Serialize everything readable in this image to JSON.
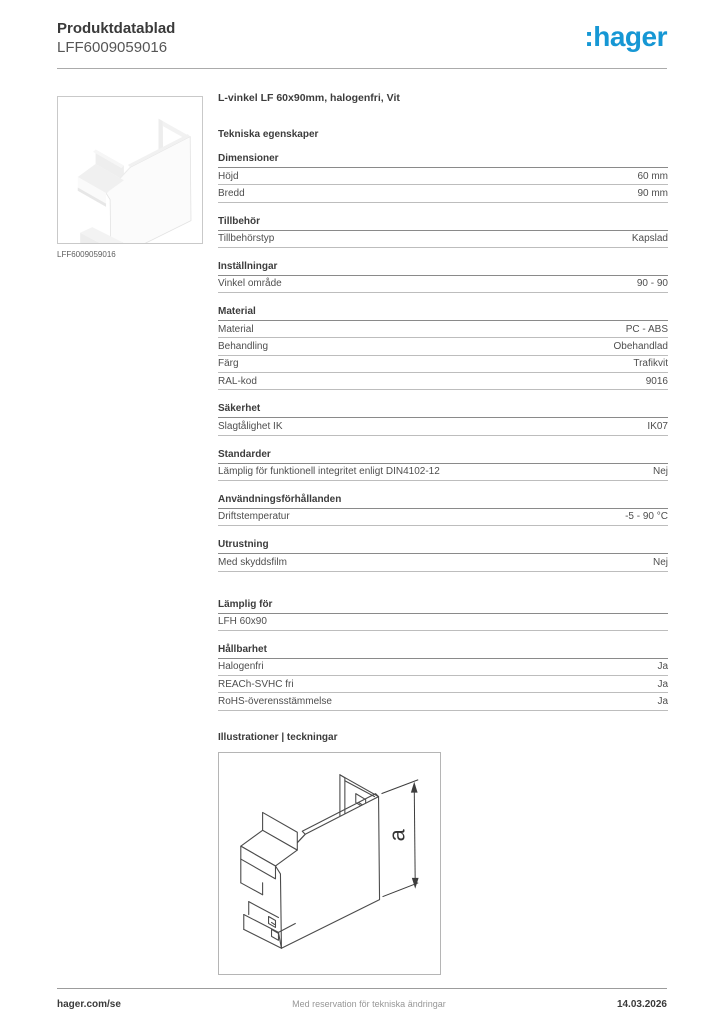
{
  "header": {
    "doc_type": "Produktdatablad",
    "reference": "LFF6009059016",
    "logo_text": ":hager",
    "brand_color": "#1697d4"
  },
  "product_image": {
    "caption": "LFF6009059016",
    "description": "white L-shaped flat-angle cover piece"
  },
  "product": {
    "title": "L-vinkel LF 60x90mm, halogenfri, Vit"
  },
  "specs": {
    "title": "Tekniska egenskaper",
    "sections": [
      {
        "title": "Dimensioner",
        "rows": [
          {
            "label": "Höjd",
            "value": "60 mm"
          },
          {
            "label": "Bredd",
            "value": "90 mm"
          }
        ]
      },
      {
        "title": "Tillbehör",
        "rows": [
          {
            "label": "Tillbehörstyp",
            "value": "Kapslad"
          }
        ]
      },
      {
        "title": "Inställningar",
        "rows": [
          {
            "label": "Vinkel område",
            "value": "90 - 90"
          }
        ]
      },
      {
        "title": "Material",
        "rows": [
          {
            "label": "Material",
            "value": "PC - ABS"
          },
          {
            "label": "Behandling",
            "value": "Obehandlad"
          },
          {
            "label": "Färg",
            "value": "Trafikvit"
          },
          {
            "label": "RAL-kod",
            "value": "9016"
          }
        ]
      },
      {
        "title": "Säkerhet",
        "rows": [
          {
            "label": "Slagtålighet IK",
            "value": "IK07"
          }
        ]
      },
      {
        "title": "Standarder",
        "rows": [
          {
            "label": "Lämplig för funktionell integritet enligt DIN4102-12",
            "value": "Nej"
          }
        ]
      },
      {
        "title": "Användningsförhållanden",
        "rows": [
          {
            "label": "Driftstemperatur",
            "value": "-5 - 90 °C"
          }
        ]
      },
      {
        "title": "Utrustning",
        "rows": [
          {
            "label": "Med skyddsfilm",
            "value": "Nej"
          }
        ]
      },
      {
        "title": "Lämplig för",
        "gap_before": true,
        "rows": [
          {
            "label": "LFH 60x90",
            "value": ""
          }
        ]
      },
      {
        "title": "Hållbarhet",
        "rows": [
          {
            "label": "Halogenfri",
            "value": "Ja"
          },
          {
            "label": "REACh-SVHC fri",
            "value": "Ja"
          },
          {
            "label": "RoHS-överensstämmelse",
            "value": "Ja"
          }
        ]
      }
    ]
  },
  "illustrations": {
    "title": "Illustrationer | teckningar",
    "dimension_label": "a"
  },
  "footer": {
    "left": "hager.com/se",
    "center": "Med reservation för tekniska ändringar",
    "right": "14.03.2026"
  }
}
